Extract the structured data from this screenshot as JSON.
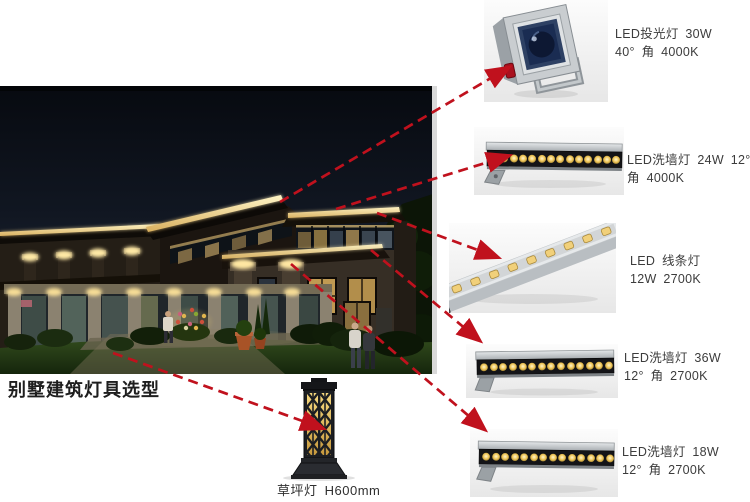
{
  "title": "别墅建筑灯具选型",
  "colors": {
    "arrow": "#c0111d",
    "label_text": "#3c3c3c",
    "fascia_light": "#f2dc95",
    "led_warm": "#f0c75a"
  },
  "fixtures": [
    {
      "id": "led-floodlight",
      "line1": "LED投光灯 30W",
      "line2": "40° 角 4000K"
    },
    {
      "id": "led-wall-washer-24w",
      "line1": "LED洗墙灯 24W 12°",
      "line2": "角 4000K"
    },
    {
      "id": "led-linear-light",
      "line1": "LED 线条灯",
      "line2": "12W 2700K"
    },
    {
      "id": "led-wall-washer-36w",
      "line1": "LED洗墙灯 36W",
      "line2": "12° 角 2700K"
    },
    {
      "id": "led-wall-washer-18w",
      "line1": "LED洗墙灯 18W",
      "line2": "12° 角 2700K"
    },
    {
      "id": "lawn-lamp",
      "label": "草坪灯 H600mm"
    }
  ],
  "connections": [
    {
      "from": "rear-roof-fascia",
      "to": "led-floodlight"
    },
    {
      "from": "upper-roof-fascia",
      "to": "led-wall-washer-24w"
    },
    {
      "from": "front-roof-corner",
      "to": "led-linear-light"
    },
    {
      "from": "second-floor-eave",
      "to": "led-wall-washer-36w"
    },
    {
      "from": "column-capital-light",
      "to": "led-wall-washer-18w"
    },
    {
      "from": "garden-lawn",
      "to": "lawn-lamp"
    }
  ]
}
